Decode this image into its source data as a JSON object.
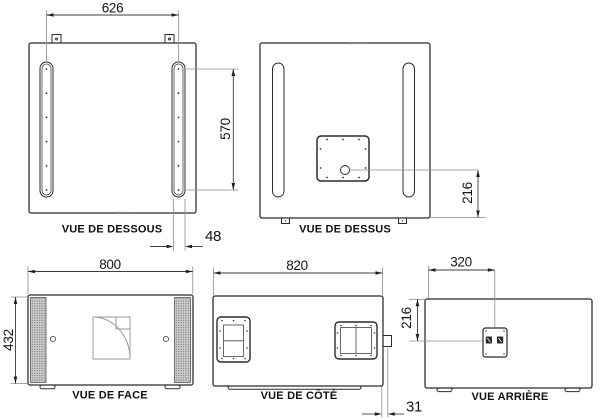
{
  "drawing": {
    "colors": {
      "line": "#2b2b2b",
      "background": "#ffffff",
      "grille": "#cfcfcf"
    },
    "views": {
      "bottom": {
        "label": "VUE DE DESSOUS",
        "dims": {
          "rail_spacing": "626",
          "rail_length": "570",
          "rail_width": "48"
        }
      },
      "top": {
        "label": "VUE DE DESSUS",
        "dims": {
          "hole_offset": "216"
        }
      },
      "front": {
        "label": "VUE DE FACE",
        "dims": {
          "width": "800",
          "height": "432"
        }
      },
      "side": {
        "label": "VUE DE CÔTÉ",
        "dims": {
          "depth": "820",
          "runner_offset": "31"
        }
      },
      "rear": {
        "label": "VUE ARRIÈRE",
        "dims": {
          "panel_offset_x": "320",
          "panel_offset_y": "216"
        }
      }
    }
  }
}
